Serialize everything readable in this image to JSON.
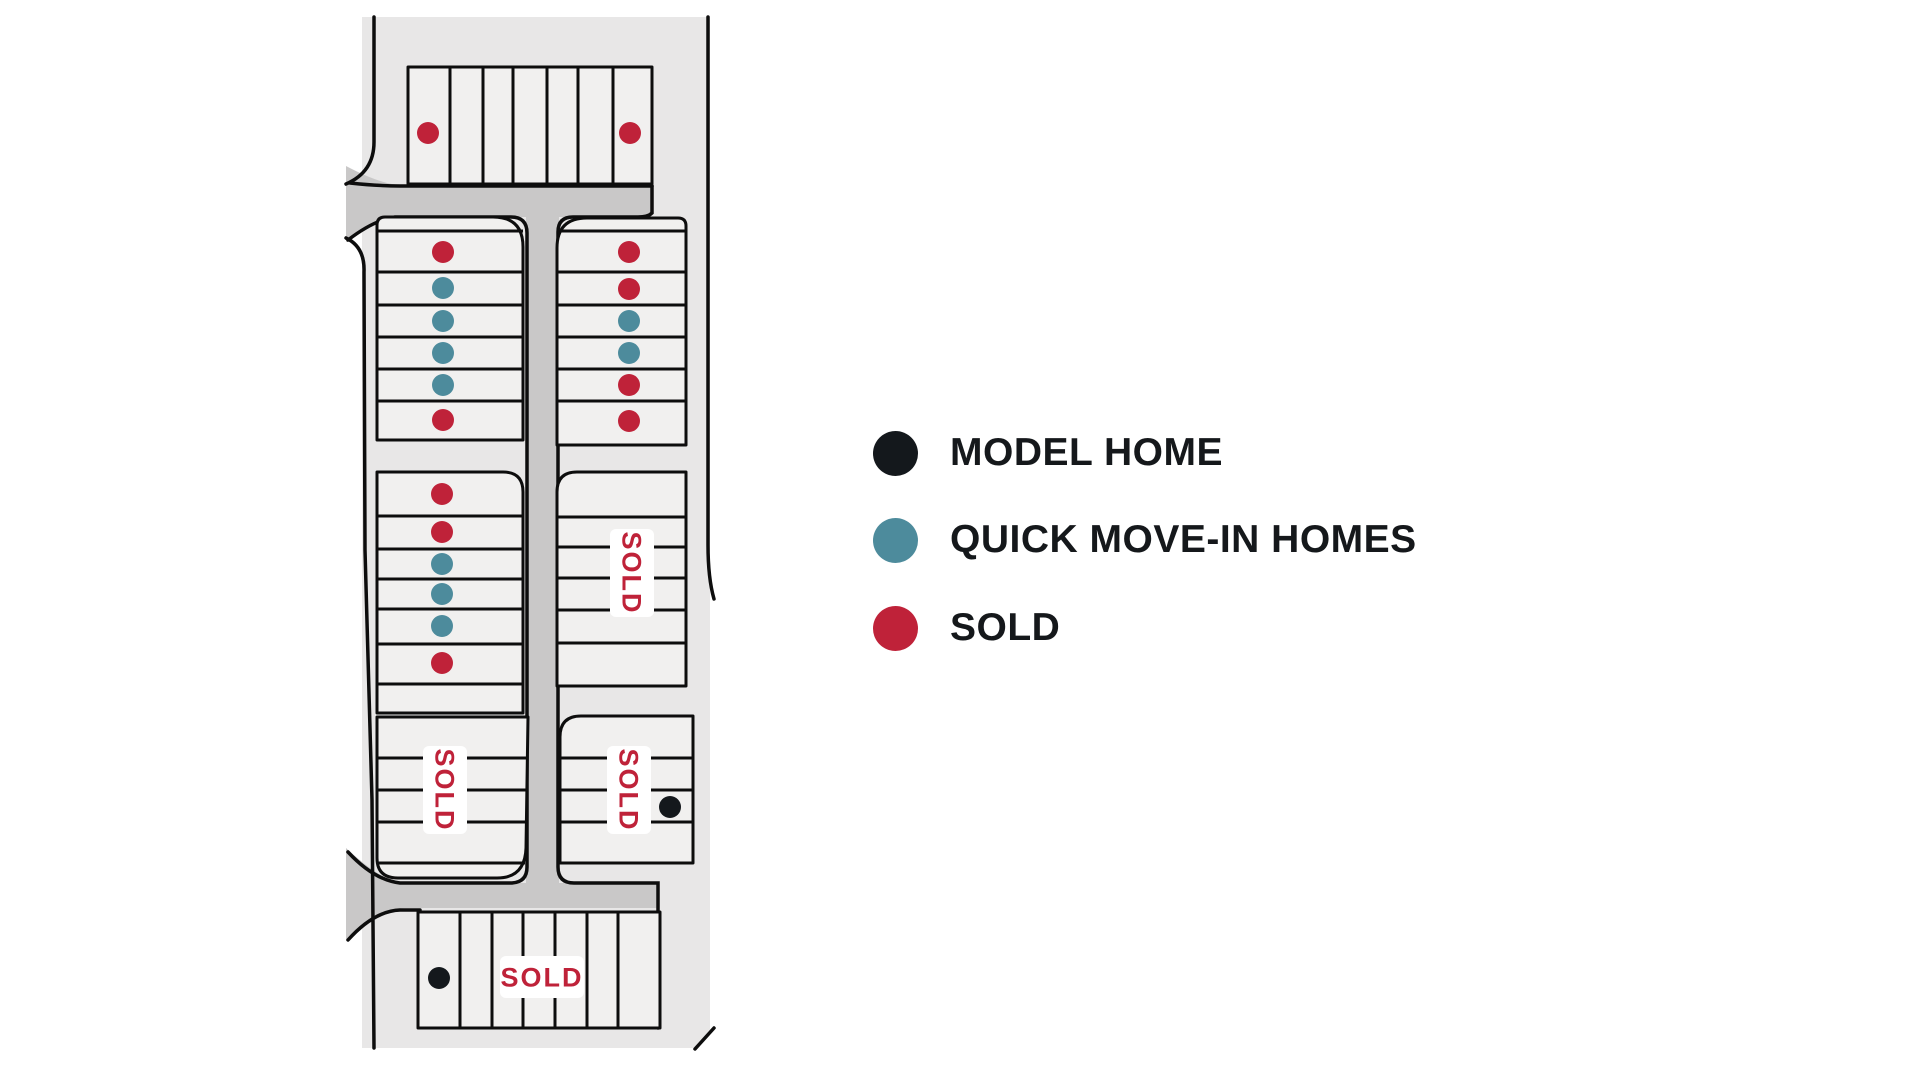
{
  "colors": {
    "model_home": "#14181c",
    "quick_move_in": "#4d8b9c",
    "sold": "#bf2239",
    "parcel": "#e8e7e7",
    "road": "#c9c8c8",
    "lot_fill": "#f1f0ef",
    "outline": "#0d0d0d",
    "label_bg": "#ffffff",
    "legend_text": "#15181b"
  },
  "legend": {
    "items": [
      {
        "key": "model_home",
        "label": "MODEL HOME"
      },
      {
        "key": "quick_move_in",
        "label": "QUICK MOVE-IN HOMES"
      },
      {
        "key": "sold",
        "label": "SOLD"
      }
    ]
  },
  "site_plan": {
    "sold_label_text": "SOLD",
    "dot_radius": 11,
    "dots": [
      {
        "x": 428,
        "y": 133,
        "status": "sold"
      },
      {
        "x": 630,
        "y": 133,
        "status": "sold"
      },
      {
        "x": 443,
        "y": 252,
        "status": "sold"
      },
      {
        "x": 443,
        "y": 288,
        "status": "quick_move_in"
      },
      {
        "x": 443,
        "y": 321,
        "status": "quick_move_in"
      },
      {
        "x": 443,
        "y": 353,
        "status": "quick_move_in"
      },
      {
        "x": 443,
        "y": 385,
        "status": "quick_move_in"
      },
      {
        "x": 443,
        "y": 420,
        "status": "sold"
      },
      {
        "x": 629,
        "y": 252,
        "status": "sold"
      },
      {
        "x": 629,
        "y": 289,
        "status": "sold"
      },
      {
        "x": 629,
        "y": 321,
        "status": "quick_move_in"
      },
      {
        "x": 629,
        "y": 353,
        "status": "quick_move_in"
      },
      {
        "x": 629,
        "y": 385,
        "status": "sold"
      },
      {
        "x": 629,
        "y": 421,
        "status": "sold"
      },
      {
        "x": 442,
        "y": 494,
        "status": "sold"
      },
      {
        "x": 442,
        "y": 532,
        "status": "sold"
      },
      {
        "x": 442,
        "y": 564,
        "status": "quick_move_in"
      },
      {
        "x": 442,
        "y": 594,
        "status": "quick_move_in"
      },
      {
        "x": 442,
        "y": 626,
        "status": "quick_move_in"
      },
      {
        "x": 442,
        "y": 663,
        "status": "sold"
      },
      {
        "x": 670,
        "y": 807,
        "status": "model_home"
      },
      {
        "x": 439,
        "y": 978,
        "status": "model_home"
      }
    ],
    "sold_labels": [
      {
        "x": 632,
        "y": 573,
        "vertical": true
      },
      {
        "x": 445,
        "y": 790,
        "vertical": true
      },
      {
        "x": 629,
        "y": 790,
        "vertical": true
      },
      {
        "x": 542,
        "y": 977,
        "vertical": false
      }
    ]
  }
}
